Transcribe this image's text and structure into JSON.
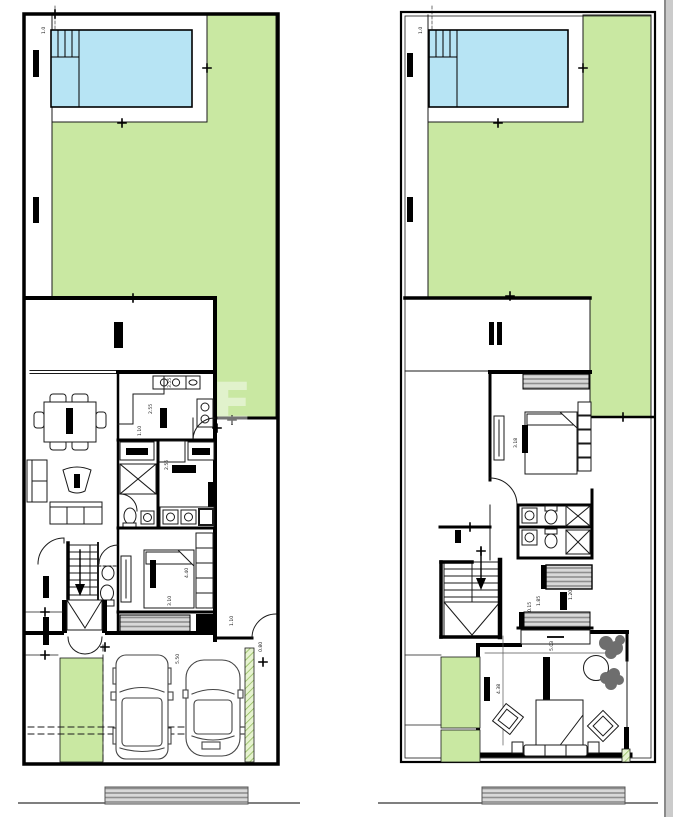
{
  "document": {
    "type": "architectural floor plans",
    "plans": [
      {
        "id": "ground-floor-plan",
        "features": [
          "pool",
          "pool-steps",
          "lawn",
          "terrace",
          "dining-table",
          "sofas",
          "kitchen",
          "stove",
          "fridge",
          "closets",
          "shower",
          "toilets",
          "bedroom",
          "bed",
          "wardrobe",
          "stairs-down",
          "entry-double-door",
          "deck-hatch",
          "garage",
          "suv",
          "sedan",
          "planter-strip",
          "hedge-strip",
          "sidewalk-hatch"
        ]
      },
      {
        "id": "upper-floor-plan",
        "features": [
          "pool",
          "lawn",
          "terrace",
          "bedroom",
          "bed",
          "desk",
          "wardrobe",
          "double-bathroom",
          "showers",
          "sinks",
          "toilets",
          "balcony-hatch",
          "stairs-down",
          "master-bedroom",
          "dresser",
          "plants",
          "round-table",
          "ottomans",
          "bench",
          "planter-strips",
          "sidewalk-hatch"
        ]
      }
    ]
  },
  "dimensions": {
    "ground": [
      "1.0",
      "3.55",
      "2.55",
      "1.10",
      "2.55",
      "4.40",
      "3.10",
      "5.50",
      "1.10",
      "0.80"
    ],
    "upper": [
      "1.0",
      "3.18",
      "1.85",
      "1.20",
      "0.15",
      "5.03",
      "4.38"
    ]
  },
  "watermark": {
    "text": "E"
  },
  "colors": {
    "wall": "#000000",
    "thin_line": "#1a1a1a",
    "lawn": "#c9e8a2",
    "pool": "#b7e4f4",
    "hatch_bg": "#d8d8d8",
    "hatch_line": "#8e8e8e",
    "hedge_bg": "#e6f3d0",
    "hedge_line": "#86b34d",
    "plant": "#6e6e6e",
    "scrollbar": "#cbcbcb",
    "scrollbar_edge": "#8a8a8a",
    "dim_text": "#111111"
  }
}
